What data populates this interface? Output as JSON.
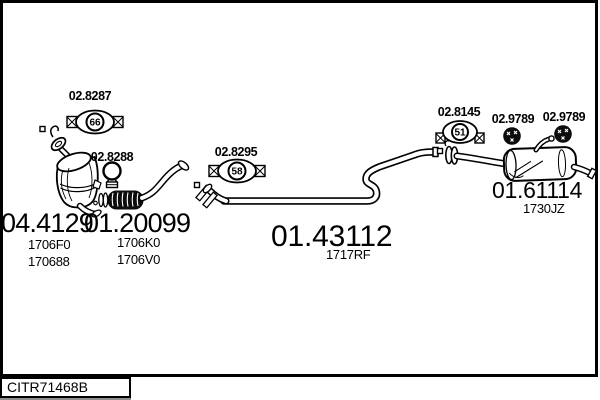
{
  "colors": {
    "line": "#000000",
    "background": "#ffffff",
    "flex_fill": "#0c0c0c"
  },
  "footer": {
    "catalog_code": "CITR71468B"
  },
  "parts": {
    "gasket_front": {
      "label": "02.8287",
      "badge": "66",
      "icon": "flange-gasket-icon"
    },
    "clamp": {
      "label": "02.8288",
      "icon": "pipe-clamp-icon"
    },
    "gasket_center": {
      "label": "02.8295",
      "badge": "58",
      "icon": "flange-gasket-icon"
    },
    "gasket_rear": {
      "label": "02.8145",
      "badge": "51",
      "icon": "flange-gasket-icon"
    },
    "mount_front": {
      "label": "02.9789",
      "icon": "rubber-mount-icon"
    },
    "mount_rear": {
      "label": "02.9789",
      "icon": "rubber-mount-icon"
    },
    "catalyst": {
      "label": "04.4129",
      "codes": [
        "1706F0",
        "170688"
      ]
    },
    "front_pipe": {
      "label": "01.20099",
      "codes": [
        "1706K0",
        "1706V0"
      ]
    },
    "center_pipe": {
      "label": "01.43112",
      "codes": [
        "1717RF"
      ]
    },
    "rear_silencer": {
      "label": "01.61114",
      "codes": [
        "1730JZ"
      ]
    }
  }
}
